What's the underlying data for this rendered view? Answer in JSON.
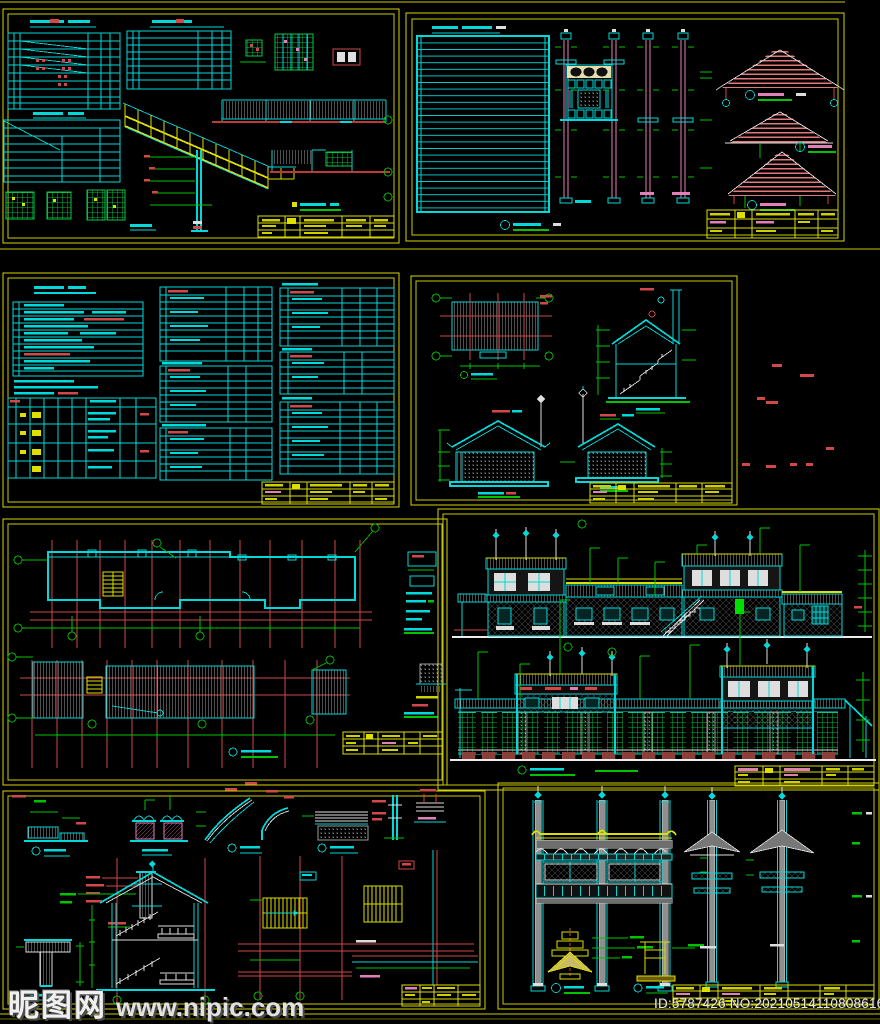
{
  "canvas": {
    "width": 880,
    "height": 1024,
    "background": "#000000"
  },
  "watermark": {
    "site_logo_text": "昵图网",
    "site_url_text": "www.nipic.com"
  },
  "footer": {
    "image_id_text": "ID:5787426 NO:20210514110808616103"
  },
  "palette": {
    "sheet_border_yellow": "#d4d400",
    "cad_cyan": "#00d9d9",
    "cad_green": "#00c300",
    "cad_red": "#d04848",
    "cad_pink": "#e080b8",
    "cad_white": "#dedede",
    "cad_yellow": "#dede00",
    "hatch_gray": "#8d8d8d",
    "roof_pink": "#e37878",
    "lattice_green": "#00cc44",
    "cream": "#e6dcae"
  },
  "sheets": [
    {
      "name": "stair-and-railing-details",
      "region": "row1-left"
    },
    {
      "name": "column-and-roof-gable-details",
      "region": "row1-right"
    },
    {
      "name": "schedules-and-notes-tables",
      "region": "row2-left"
    },
    {
      "name": "roof-plan-and-section-elevations",
      "region": "row2-right"
    },
    {
      "name": "floor-plan-and-roof-plan",
      "region": "row3-left"
    },
    {
      "name": "street-building-elevations",
      "region": "row3-right"
    },
    {
      "name": "construction-details-and-stairs",
      "region": "row4-left"
    },
    {
      "name": "paifang-gate-elevation-details",
      "region": "row4-right"
    }
  ]
}
